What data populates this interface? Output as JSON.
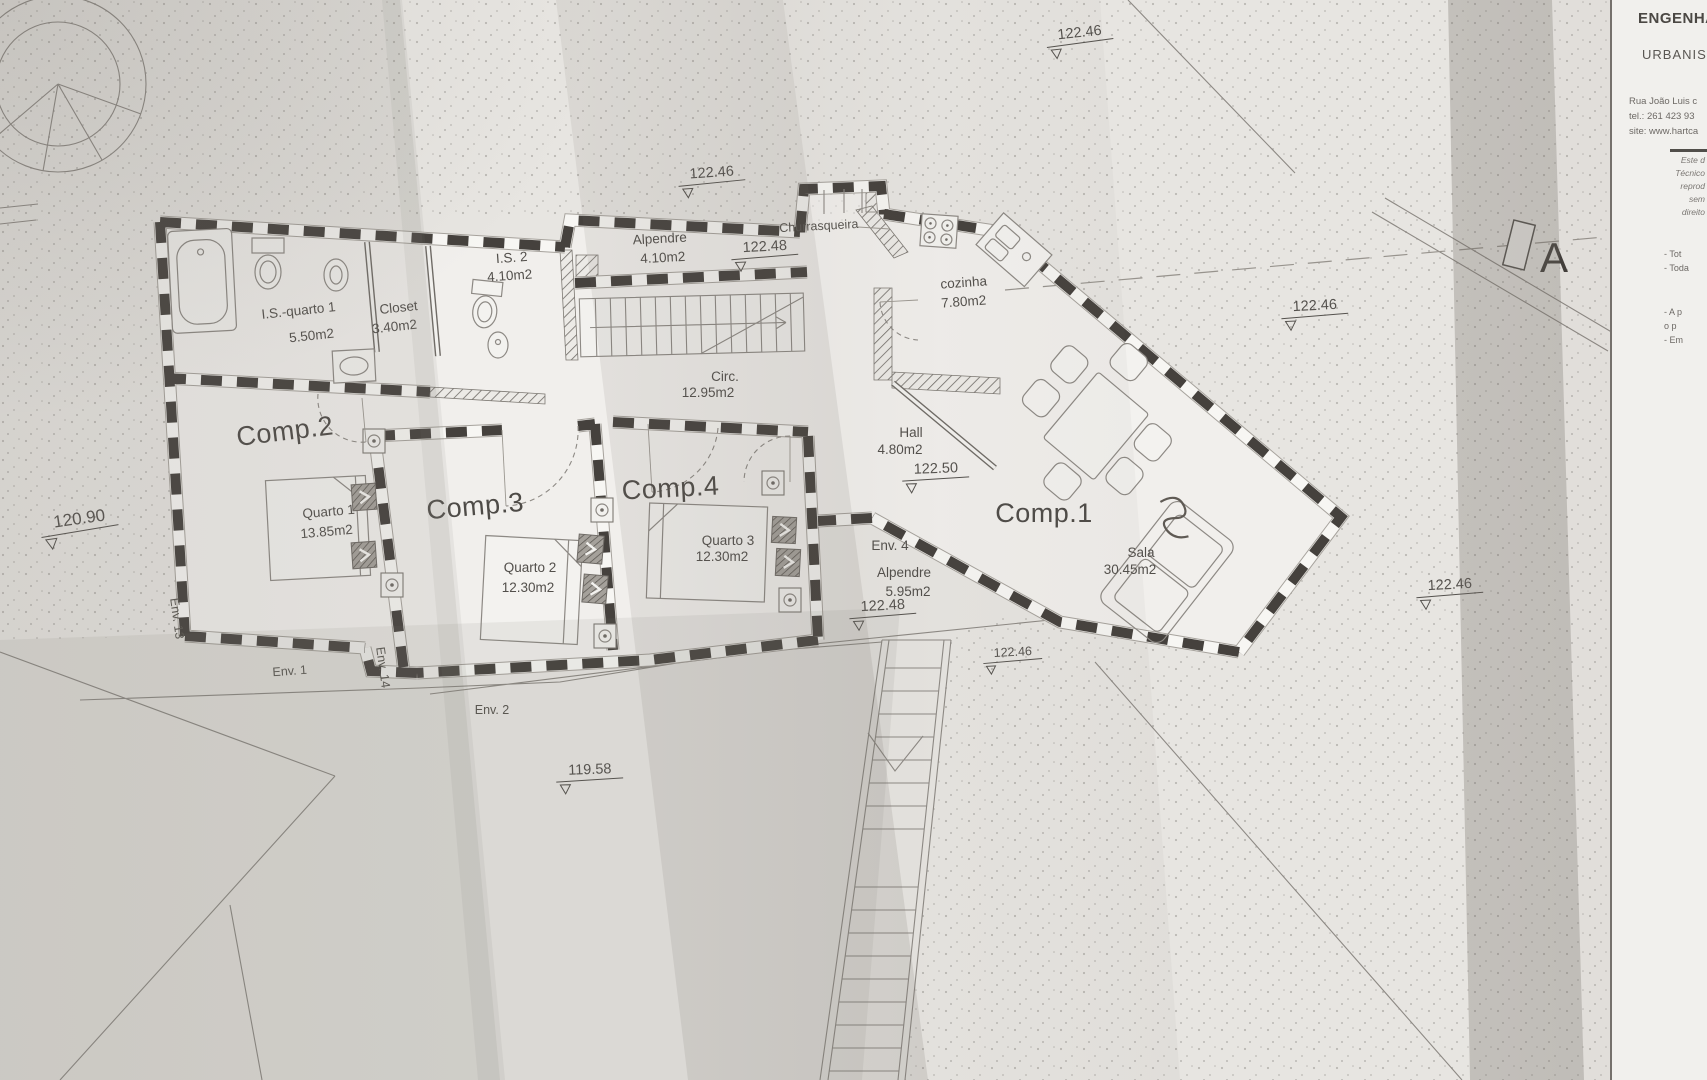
{
  "title_block": {
    "company_line1": "ENGENHA",
    "company_line2": "URBANIS",
    "address_line": "Rua João Luis c",
    "tel_line": "tel.: 261 423 93",
    "site_line": "site: www.hartca",
    "disclaimer": [
      "Este d",
      "Técnico",
      "reprod",
      "sem",
      "direito"
    ],
    "notes": [
      "- Tot",
      "- Toda",
      "- A p",
      "o p",
      "- Em"
    ]
  },
  "section_marker": {
    "label": "A"
  },
  "rooms": {
    "is_quarto1": {
      "name": "I.S.-quarto 1",
      "area": "5.50m2"
    },
    "closet": {
      "name": "Closet",
      "area": "3.40m2"
    },
    "is2": {
      "name": "I.S. 2",
      "area": "4.10m2"
    },
    "alpendre_top": {
      "name": "Alpendre",
      "area": "4.10m2"
    },
    "churrasqueira": {
      "name": "Churrasqueira"
    },
    "cozinha": {
      "name": "cozinha",
      "area": "7.80m2"
    },
    "circ": {
      "name": "Circ.",
      "area": "12.95m2"
    },
    "hall": {
      "name": "Hall",
      "area": "4.80m2"
    },
    "comp2": {
      "name": "Comp.2"
    },
    "quarto1": {
      "name": "Quarto 1",
      "area": "13.85m2"
    },
    "comp3": {
      "name": "Comp.3"
    },
    "quarto2": {
      "name": "Quarto 2",
      "area": "12.30m2"
    },
    "comp4": {
      "name": "Comp.4"
    },
    "quarto3": {
      "name": "Quarto 3",
      "area": "12.30m2"
    },
    "comp1": {
      "name": "Comp.1"
    },
    "sala": {
      "name": "Sala",
      "area": "30.45m2"
    },
    "env4": {
      "name": "Env. 4"
    },
    "alpendre_env4": {
      "name": "Alpendre",
      "area": "5.95m2"
    }
  },
  "env_labels": {
    "env1": "Env. 1",
    "env2": "Env. 2",
    "env13": "Env. 13",
    "env14": "Env. 14"
  },
  "elevations": {
    "top_center": "122.46",
    "top_right": "122.46",
    "alpendre": "122.48",
    "mid_right": "122.46",
    "hall": "122.50",
    "env4": "122.48",
    "terrace": "122.46",
    "bottom_right": "122.46",
    "west": "120.90",
    "south": "119.58"
  }
}
